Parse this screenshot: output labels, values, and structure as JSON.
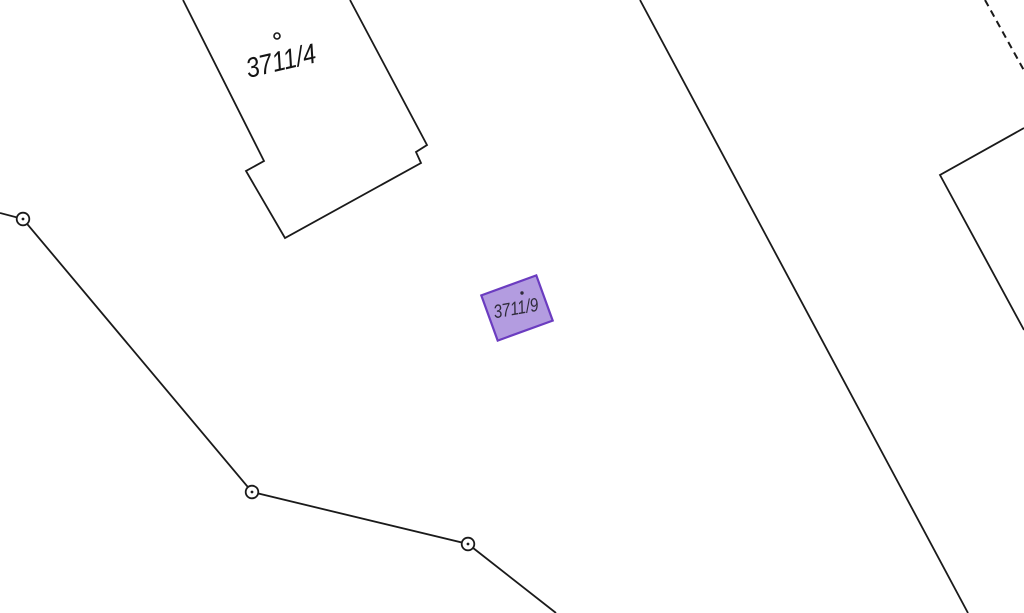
{
  "map": {
    "background_color": "#ffffff",
    "line_color": "#1a1a1a",
    "parcels": [
      {
        "label": "3711/4",
        "type": "outlined-building-parcel"
      },
      {
        "label": "3711/9",
        "type": "highlighted-parcel",
        "fill_color": "#b39ce0",
        "border_color": "#6b3cc0",
        "label_color": "#2f2b3a"
      }
    ],
    "markers": {
      "survey_point_style": "circle-with-center-dot",
      "survey_point_count": 3,
      "parcel_point_style": "small-dot"
    }
  }
}
